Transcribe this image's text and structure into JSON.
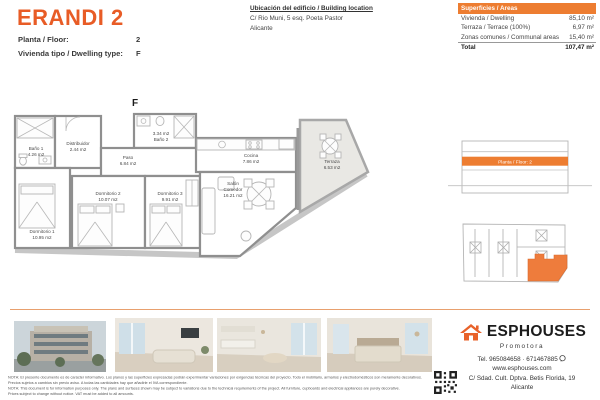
{
  "colors": {
    "accent": "#e85c26",
    "table-header": "#ed7d31",
    "unit-fill": "#ee7c3c",
    "divider": "#e8a06e",
    "logo-orange": "#e8622a"
  },
  "header": {
    "title": "ERANDI 2",
    "fields": [
      {
        "label": "Planta / Floor:",
        "value": "2"
      },
      {
        "label": "Vivienda tipo / Dwelling type:",
        "value": "F"
      }
    ],
    "location": {
      "heading": "Ubicación del edificio / Building location",
      "address": "C/ Rio Muni, 5 esq. Poeta Pastor",
      "city": "Alicante"
    },
    "areas_table": {
      "title": "Superficies / Areas",
      "rows": [
        {
          "label": "Vivienda / Dwelling",
          "value": "85,10 m²"
        },
        {
          "label": "Terraza / Terrace (100%)",
          "value": "6,97 m²"
        },
        {
          "label": "Zonas comunes / Communal areas",
          "value": "15,40 m²"
        }
      ],
      "total": {
        "label": "Total",
        "value": "107,47 m²"
      }
    }
  },
  "floorplan": {
    "unit_letter": "F",
    "rooms": {
      "banio1": {
        "line1": "Baño 1",
        "line2": "4.26 m2"
      },
      "distribuidor": {
        "line1": "Distribuidor",
        "line2": "2.44 m2"
      },
      "paso": {
        "line1": "Paso",
        "line2": "6.84 m2"
      },
      "banio2": {
        "line1": "3.34 m2",
        "line2": "Baño 2"
      },
      "cocina": {
        "line1": "Cocina",
        "line2": "7.86 m2"
      },
      "salon": {
        "line1": "Salón",
        "line2": "Comedor",
        "line3": "16.21 m2"
      },
      "terraza": {
        "line1": "Terraza",
        "line2": "6.53 m2"
      },
      "dormitorio1": {
        "line1": "Dormitorio 1",
        "line2": "10.95 m2"
      },
      "dormitorio2": {
        "line1": "Dormitorio 2",
        "line2": "10.07 m2"
      },
      "dormitorio3": {
        "line1": "Dormitorio 3",
        "line2": "9.91 m2"
      }
    }
  },
  "side": {
    "section_floor_label": "Planta / Floor: 2"
  },
  "footer": {
    "disclaimer": [
      "NOTA: El presente documento es de carácter informativo. Los planos y las superficies expresadas podrán experimentar variaciones por exigencias técnicas del proyecto. Todo el mobiliario, armarios y electrodomésticos son meramente decorativos.",
      "Precios sujetos a cambios sin previo aviso. A todas las cantidades hay que añadirle el IVA correspondiente.",
      "NOTA: This document is for information purposes only. The plans and surfaces shown may be subject to variations due to the technical requirements of the project. All furniture, cupboards and electrical appliances are purely decorative.",
      "Prices subject to change without notice. VAT must be added to all amounts."
    ],
    "brand": {
      "name": "ESPHOUSES",
      "tagline": "Promotora",
      "tel": "Tel. 965084658 · 671467885",
      "web": "www.esphouses.com",
      "address": "C/ Sdad. Cult. Dptva. Betis Florida, 19",
      "city": "Alicante"
    }
  }
}
